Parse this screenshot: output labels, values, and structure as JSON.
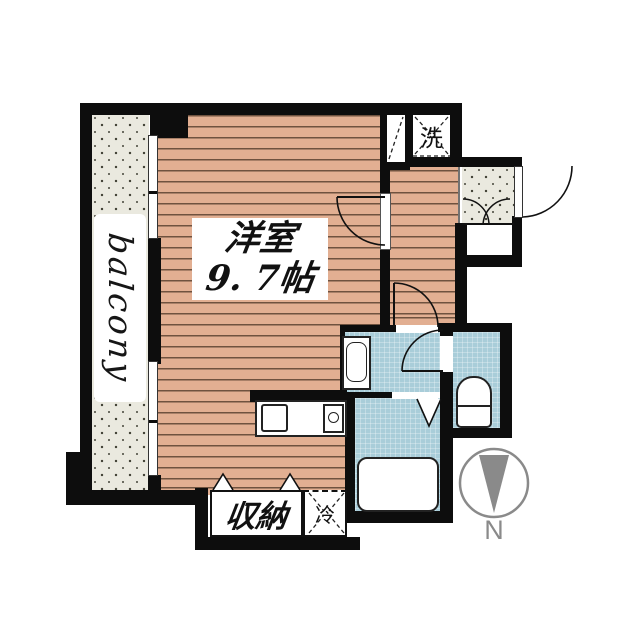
{
  "labels": {
    "room": {
      "line1": "洋室",
      "line2": "9. 7帖"
    },
    "balcony": "balcony",
    "washer": "洗",
    "closet": "収納",
    "fridge": "冷",
    "compass_north": "N"
  },
  "colors": {
    "wall": "#0d0d0d",
    "wood_floor": "#e2af92",
    "wood_joint": "#6f523f",
    "wet_area_tile": "#a9cdd9",
    "balcony_floor": "#eae9df",
    "compass_gray": "#8a8a8a",
    "fixture_outline": "#222222"
  }
}
